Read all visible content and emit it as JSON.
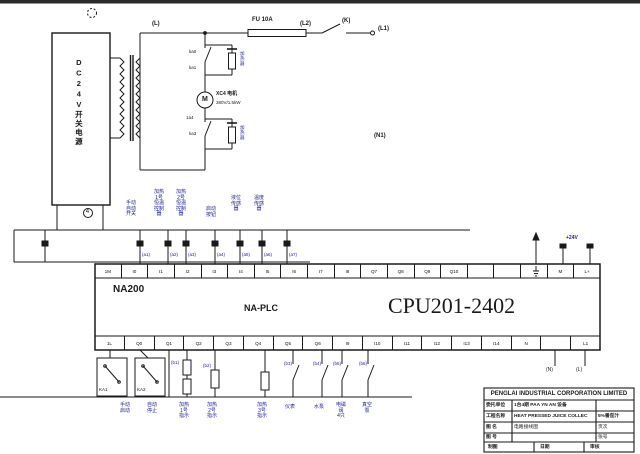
{
  "power_supply": {
    "label": "DC24V开关电源",
    "node_tag": "4"
  },
  "top_circuit": {
    "l_tag": "(L)",
    "fuse_label": "FU 10A",
    "l2_tag": "(L2)",
    "k_tag": "(K)",
    "l1_tag": "(L1)",
    "n1_tag": "(N1)",
    "contact_tags": [
      "ka0",
      "ka1",
      "1a4",
      "ka3"
    ],
    "heater_labels": [
      "加\n热\n器",
      "加\n热\n器"
    ],
    "motor": {
      "symbol": "M",
      "name": "XC4 电机",
      "spec": "380V/1.5kW"
    }
  },
  "inputs": {
    "labels": [
      "手动\n自动\n开关",
      "加热\n1号\n恒温\n控制\n器",
      "加热\n2号\n恒温\n控制\n器",
      "启动\n按钮",
      "液位\n传感\n器",
      "温度\n传感\n器"
    ],
    "wire_tags": [
      "(a1)",
      "(a2)",
      "(a3)",
      "(a4)",
      "(a5)",
      "(a6)",
      "(a7)"
    ]
  },
  "plc": {
    "brand": "NA200",
    "series": "NA-PLC",
    "model": "CPU201-2402",
    "power_tag": "+24V",
    "top_terminals": [
      "1M",
      "I0",
      "I1",
      "I2",
      "I3",
      "I4",
      "I5",
      "I6",
      "I7",
      "I8",
      "Q7",
      "Q8",
      "Q9",
      "Q10",
      "",
      "",
      "",
      "M",
      "L+"
    ],
    "bottom_terminals": [
      "1L",
      "Q0",
      "Q1",
      "Q2",
      "Q3",
      "Q4",
      "Q5",
      "Q6",
      "I9",
      "I10",
      "I11",
      "I12",
      "I13",
      "I14",
      "N",
      "",
      "L1"
    ]
  },
  "outputs": {
    "relay_tags": [
      "KA1",
      "KA2"
    ],
    "wire_tags": [
      "(b1)",
      "(b2)",
      "(b3)",
      "(b4)",
      "(b5)",
      "(b6)"
    ],
    "ac_tags": [
      "(N)",
      "(L)"
    ],
    "labels": [
      "手动\n启动",
      "自动\n停止",
      "加热\n1号\n指示",
      "加热\n2号\n指示",
      "加热\n3号\n指示",
      "仪表",
      "水泵",
      "电磁\n阀\n4只",
      "真空\n泵"
    ]
  },
  "title_block": {
    "company": "PENGLAI INDUSTRIAL CORPORATION LIMITED",
    "rows": [
      {
        "label": "委托单位",
        "value": "1台4期 PAA YN AN 设备",
        "extra": ""
      },
      {
        "label": "工程名称",
        "value": "HEAT PRESSED JUICE COLLEC",
        "extra": "5%番茄汁"
      },
      {
        "label": "图 名",
        "value": "电路接线图",
        "extra": "页次"
      },
      {
        "label": "图 号",
        "value": "",
        "extra": "张号"
      }
    ],
    "footer": [
      "制图",
      "日期",
      "审核"
    ]
  }
}
